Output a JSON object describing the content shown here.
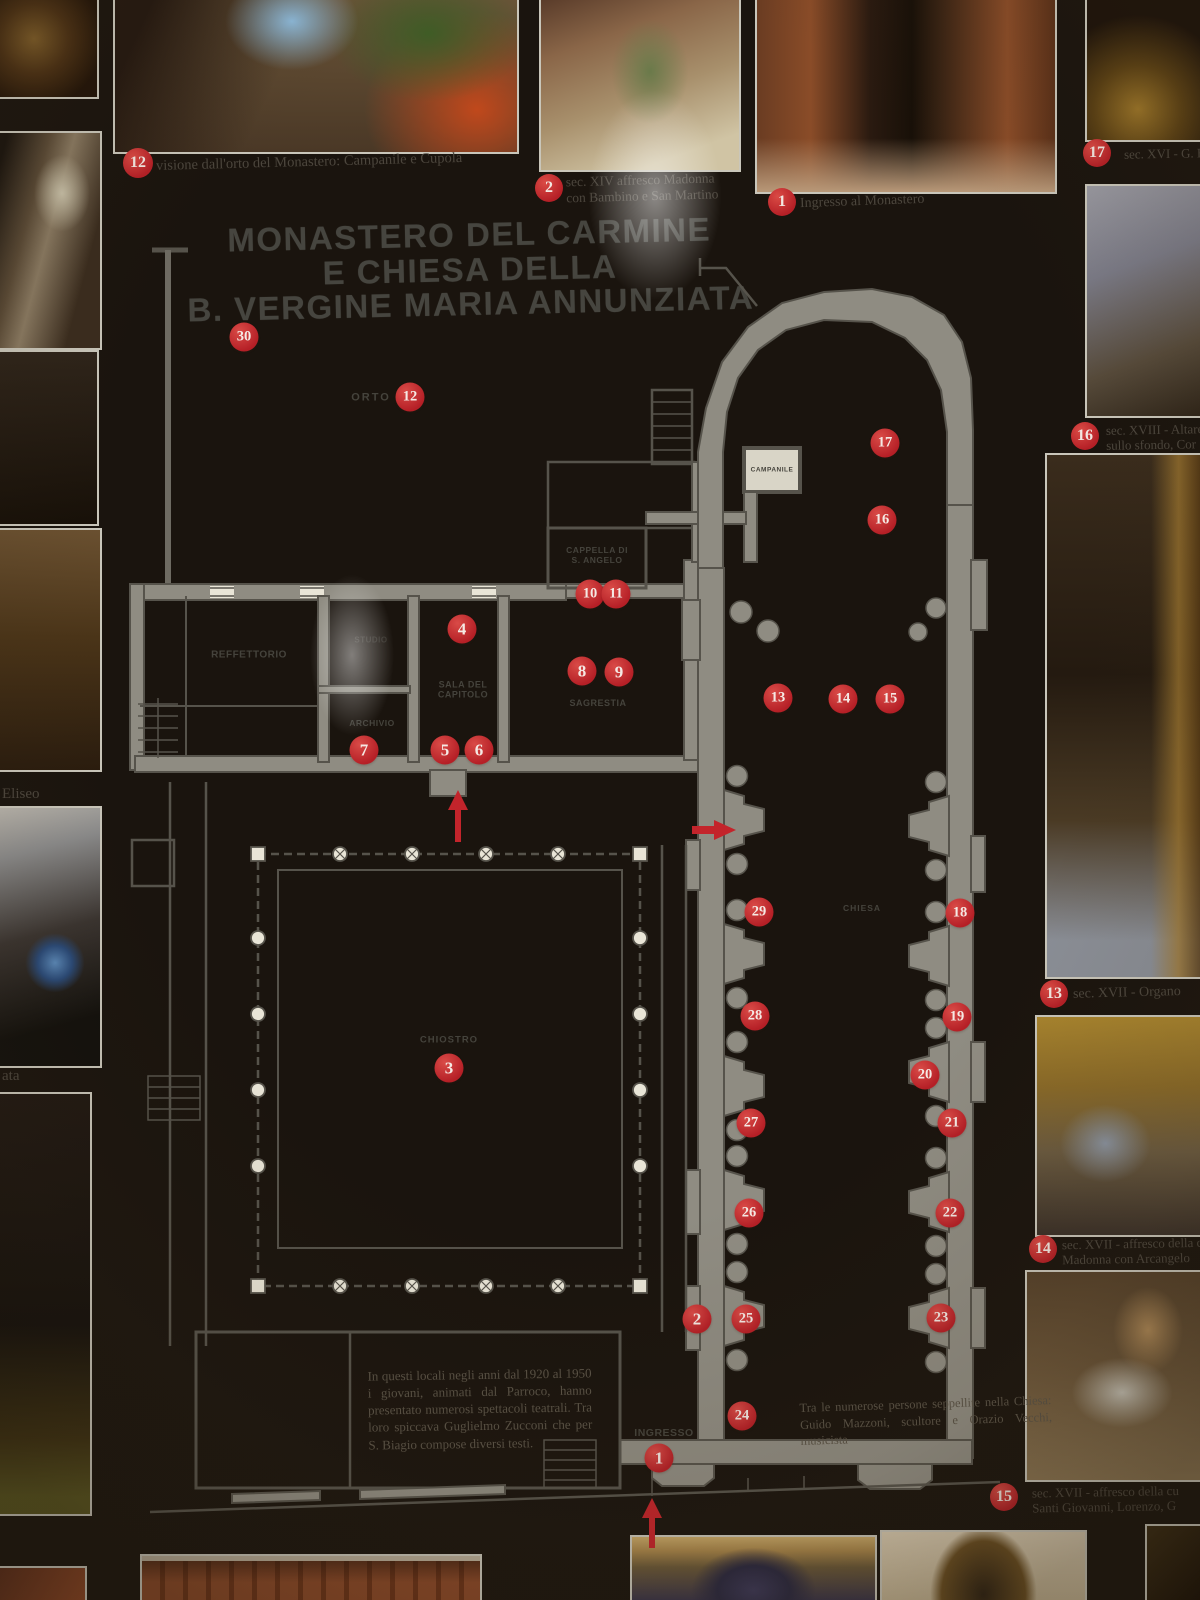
{
  "title": {
    "lines": [
      "MONASTERO DEL CARMINE",
      "E CHIESA DELLA",
      "B. VERGINE MARIA ANNUNZIATA"
    ]
  },
  "photo_captions": {
    "c12": {
      "num": "12",
      "text": "visione dall'orto del Monastero: Campanile e Cupola"
    },
    "c2": {
      "num": "2",
      "line1": "sec. XIV affresco Madonna",
      "line2": "con Bambino e San Martino"
    },
    "c1": {
      "num": "1",
      "text": "Ingresso al Monastero"
    },
    "c17": {
      "num": "17",
      "text": "sec. XVI - G. B."
    },
    "c16": {
      "num": "16",
      "line1": "sec. XVIII - Altare",
      "line2": "sullo sfondo, Cor"
    },
    "c13": {
      "num": "13",
      "text": "sec. XVII - Organo"
    },
    "c14": {
      "num": "14",
      "line1": "sec. XVII - affresco della c",
      "line2": "Madonna con Arcangelo"
    },
    "c15": {
      "num": "15",
      "line1": "sec. XVII - affresco della cu",
      "line2": "Santi Giovanni, Lorenzo, G"
    },
    "left_upper": "Eliseo",
    "left_lower": "ata"
  },
  "plan": {
    "labels": [
      {
        "id": "orto",
        "text": "ORTO",
        "x": 371,
        "y": 398,
        "fs": 11,
        "ls": 2
      },
      {
        "id": "campanile",
        "text": "CAMPANILE",
        "x": 772,
        "y": 470,
        "fs": 6.5,
        "ls": 0.5
      },
      {
        "id": "cappella",
        "text": "CAPPELLA DI\nS. ANGELO",
        "x": 597,
        "y": 556,
        "fs": 8.5,
        "ls": 0.5
      },
      {
        "id": "reffettorio",
        "text": "REFFETTORIO",
        "x": 249,
        "y": 655,
        "fs": 10,
        "ls": 0.5
      },
      {
        "id": "studio",
        "text": "STUDIO",
        "x": 371,
        "y": 640,
        "fs": 8,
        "ls": 0.5,
        "op": 0.55
      },
      {
        "id": "sala-del-capitolo",
        "text": "SALA DEL\nCAPITOLO",
        "x": 463,
        "y": 690,
        "fs": 9,
        "ls": 0.5
      },
      {
        "id": "archivio",
        "text": "ARCHIVIO",
        "x": 372,
        "y": 724,
        "fs": 8.5,
        "ls": 0.5
      },
      {
        "id": "sagrestia",
        "text": "SAGRESTIA",
        "x": 598,
        "y": 703,
        "fs": 9,
        "ls": 0.5
      },
      {
        "id": "chiostro",
        "text": "CHIOSTRO",
        "x": 449,
        "y": 1041,
        "fs": 9.5,
        "ls": 1
      },
      {
        "id": "chiesa",
        "text": "CHIESA",
        "x": 862,
        "y": 909,
        "fs": 8.5,
        "ls": 1
      },
      {
        "id": "ingresso",
        "text": "INGRESSO",
        "x": 664,
        "y": 1433,
        "fs": 10.5,
        "ls": 0.5
      }
    ],
    "markers": [
      {
        "n": "30",
        "x": 244,
        "y": 337
      },
      {
        "n": "12",
        "x": 410,
        "y": 397
      },
      {
        "n": "17",
        "x": 885,
        "y": 443
      },
      {
        "n": "16",
        "x": 882,
        "y": 520
      },
      {
        "n": "10",
        "x": 590,
        "y": 594
      },
      {
        "n": "11",
        "x": 616,
        "y": 594
      },
      {
        "n": "4",
        "x": 462,
        "y": 629
      },
      {
        "n": "8",
        "x": 582,
        "y": 671
      },
      {
        "n": "9",
        "x": 619,
        "y": 672
      },
      {
        "n": "13",
        "x": 778,
        "y": 698
      },
      {
        "n": "14",
        "x": 843,
        "y": 699
      },
      {
        "n": "15",
        "x": 890,
        "y": 699
      },
      {
        "n": "7",
        "x": 364,
        "y": 750
      },
      {
        "n": "5",
        "x": 445,
        "y": 750
      },
      {
        "n": "6",
        "x": 479,
        "y": 750
      },
      {
        "n": "3",
        "x": 449,
        "y": 1068
      },
      {
        "n": "29",
        "x": 759,
        "y": 912
      },
      {
        "n": "18",
        "x": 960,
        "y": 913
      },
      {
        "n": "28",
        "x": 755,
        "y": 1016
      },
      {
        "n": "19",
        "x": 957,
        "y": 1017
      },
      {
        "n": "20",
        "x": 925,
        "y": 1075
      },
      {
        "n": "27",
        "x": 751,
        "y": 1123
      },
      {
        "n": "21",
        "x": 952,
        "y": 1123
      },
      {
        "n": "26",
        "x": 749,
        "y": 1213
      },
      {
        "n": "22",
        "x": 950,
        "y": 1213
      },
      {
        "n": "2",
        "x": 697,
        "y": 1319
      },
      {
        "n": "25",
        "x": 746,
        "y": 1319
      },
      {
        "n": "23",
        "x": 941,
        "y": 1318
      },
      {
        "n": "24",
        "x": 742,
        "y": 1416
      },
      {
        "n": "1",
        "x": 659,
        "y": 1458
      }
    ],
    "notes": {
      "theater": "In questi locali negli anni dal 1920 al 1950 i giovani, animati dal Parroco, hanno presentato numerosi spettacoli teatrali. Tra loro spiccava Guglielmo Zucconi che per S. Biagio compose diversi testi.",
      "church": "Tra le numerose persone seppellite nella Chiesa: Guido Mazzoni, scultore e Orazio Vecchi, musicista"
    }
  },
  "colors": {
    "marker_red": "#c3242b",
    "wall_fill": "#8f8c82",
    "wall_line": "#56534b",
    "paper": "#e9e5d7"
  }
}
